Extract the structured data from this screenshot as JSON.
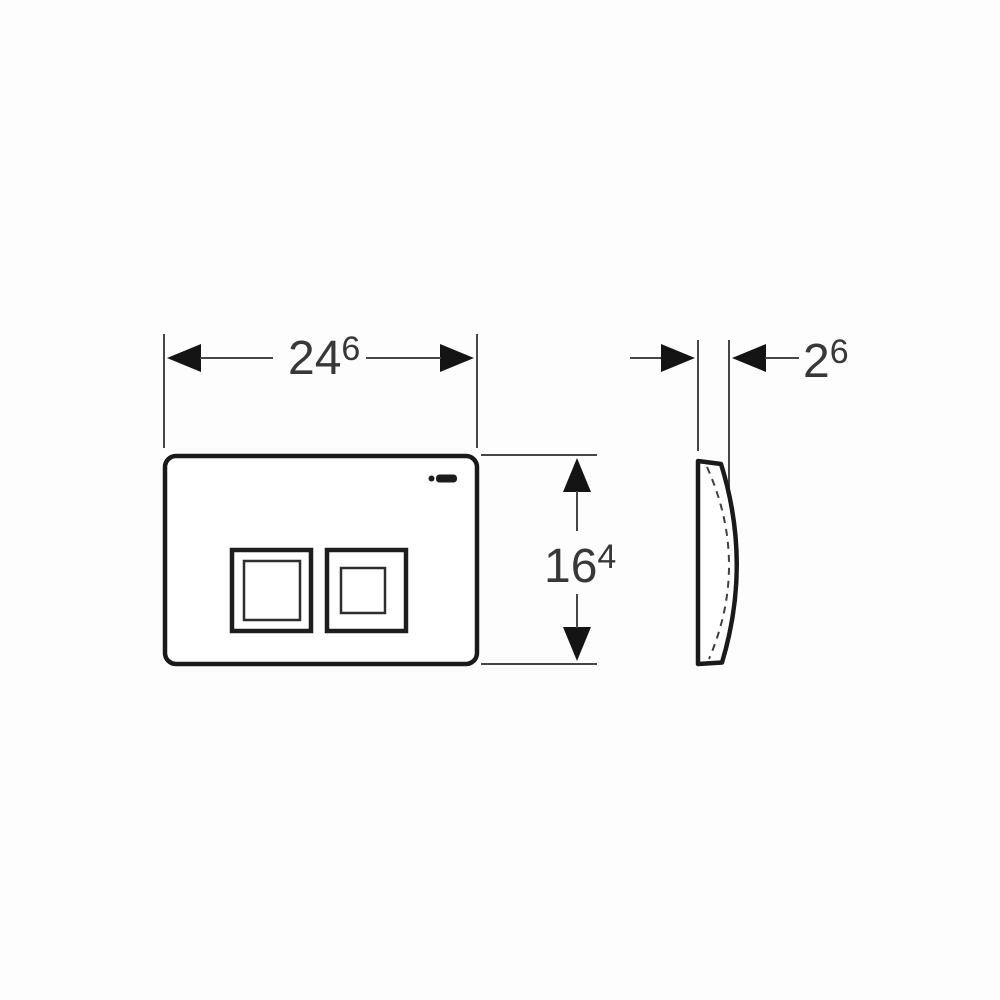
{
  "image": {
    "kind": "technical-dimension-drawing",
    "subject": "rectangular dual-flush actuator plate shown in front view and side profile view",
    "background_color": "#fdfdfd"
  },
  "style": {
    "outline_color": "#1a1a1a",
    "dimension_line_color": "#464646",
    "text_color": "#383838",
    "fill_color": "#ffffff"
  },
  "views": {
    "front": {
      "label": "front-view",
      "buttons": [
        "large-flush-button",
        "small-flush-button"
      ],
      "brand_mark_icon": "geberit-wordmark-logo"
    },
    "side": {
      "label": "side-profile-view",
      "hidden_edge_style": "dashed-inner-curve"
    }
  },
  "dimensions": {
    "width": {
      "main": "24",
      "sup": "6",
      "combined": "246"
    },
    "height": {
      "main": "16",
      "sup": "4",
      "combined": "164"
    },
    "depth": {
      "main": "2",
      "sup": "6",
      "combined": "26"
    }
  }
}
